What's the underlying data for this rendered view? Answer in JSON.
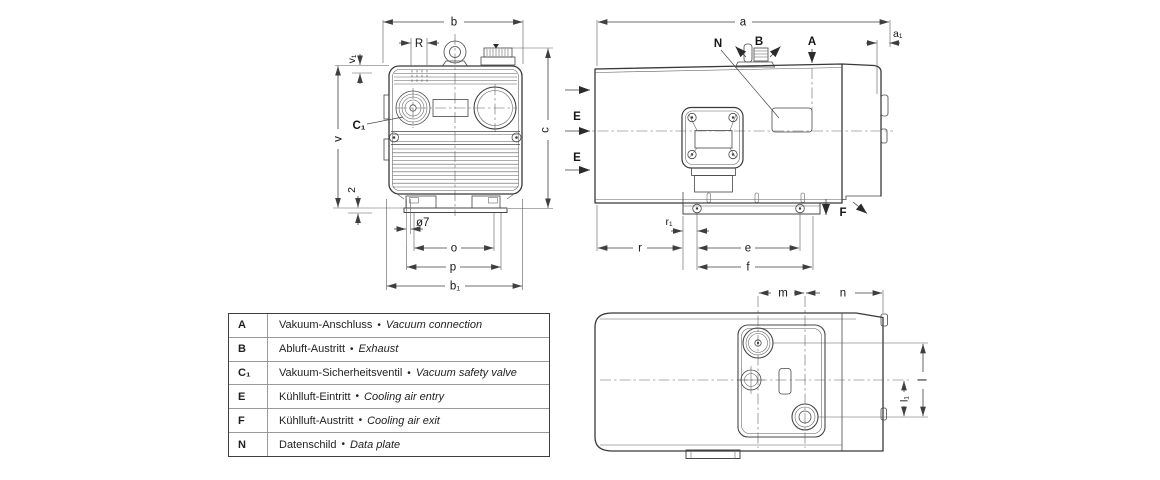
{
  "colors": {
    "line": "#3a3a3a",
    "dim": "#3f3f3f",
    "text": "#161616",
    "bg": "#ffffff"
  },
  "legend": {
    "rows": [
      {
        "symbol": "A",
        "de": "Vakuum-Anschluss",
        "bullet": "•",
        "en": "Vacuum connection"
      },
      {
        "symbol": "B",
        "de": "Abluft-Austritt",
        "bullet": "•",
        "en": "Exhaust"
      },
      {
        "symbol": "C₁",
        "de": "Vakuum-Sicherheitsventil",
        "bullet": "•",
        "en": "Vacuum safety valve"
      },
      {
        "symbol": "E",
        "de": "Kühlluft-Eintritt",
        "bullet": "•",
        "en": "Cooling air entry"
      },
      {
        "symbol": "F",
        "de": "Kühlluft-Austritt",
        "bullet": "•",
        "en": "Cooling air exit"
      },
      {
        "symbol": "N",
        "de": "Datenschild",
        "bullet": "•",
        "en": "Data plate"
      }
    ]
  },
  "front_view": {
    "dim_b": "b",
    "dim_R": "R",
    "dim_v1": "v₁",
    "dim_v": "v",
    "label_C1": "C₁",
    "dim_c": "c",
    "dim_2": "2",
    "dim_dia7": "ø7",
    "dim_o": "o",
    "dim_p": "p",
    "dim_b1": "b₁"
  },
  "side_view": {
    "dim_a": "a",
    "dim_a1": "a₁",
    "label_N": "N",
    "label_B": "B",
    "label_A": "A",
    "label_E_upper": "E",
    "label_E_lower": "E",
    "label_F": "F",
    "dim_r1": "r₁",
    "dim_r": "r",
    "dim_e": "e",
    "dim_f": "f"
  },
  "bottom_view": {
    "dim_m": "m",
    "dim_n": "n",
    "dim_l": "l",
    "dim_l1": "l₁"
  }
}
